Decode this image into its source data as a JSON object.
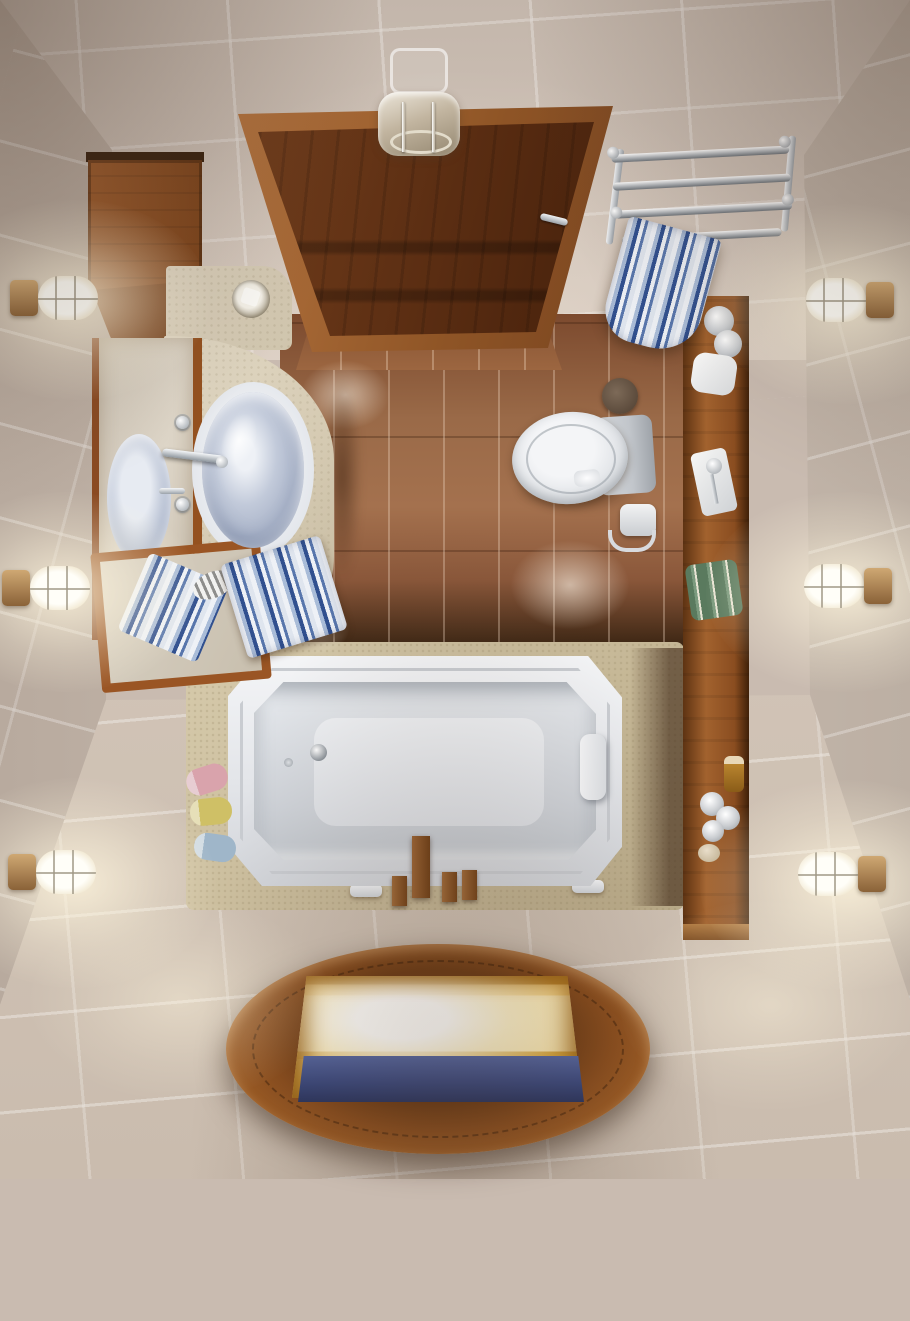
{
  "scene": {
    "description": "3D rendered top-down (bird's eye) view of a small bathroom with beige tiled walls and floor, dark wood accents, a white bathtub, corner vanity with glass vessel sink, toilet, chrome towel rack with blue striped towel, six glowing bulkhead wall lamps, and an oval wooden floor hatch glowing golden with blue water inside",
    "view": "overhead",
    "room_type": "bathroom"
  },
  "palette": {
    "wall_tile": "#cec1b6",
    "grout": "#e8ded2",
    "floor_tile_brown": "#9a6a48",
    "wood_dark": "#5a2d12",
    "wood_mid": "#8a4d20",
    "wood_light": "#a8683a",
    "stone_counter": "#d5cab2",
    "tub_white": "#eef0f3",
    "towel_navy": "#31508f",
    "towel_blue": "#a9bcd8",
    "lamp_glow": "#fff6de",
    "hatch_glow": "#f9e6ae",
    "water_blue": "#39477c",
    "chrome": "#d9dce0",
    "bronze": "#ae8a5e",
    "toilet_white": "#dcdfe3"
  },
  "counts": {
    "wall_lamps": 6,
    "sinks": 1,
    "mirrors": 2,
    "striped_towels": 3
  },
  "objects": {
    "walls": "Beige tiled walls in perspective",
    "floor": "Beige tiled floor",
    "brown_floor": "Brown tiled floor strip between door and bathtub",
    "door": "Open dark wood door seen from above",
    "door_handle": "Chrome door handle",
    "ceiling_fixture": "Glass and chrome fixture above the door",
    "cabinet": "Wall-mounted wooden storage cabinet",
    "vanity_mirror": "Wood-framed wall mirror reflecting the sink",
    "tilted_mirror": "Tilted wood-framed mirror reflecting a striped towel",
    "countertop": "Curved cream stone vanity countertop",
    "counter_slab": "Stone counter corner slab",
    "glass_cup": "Glass cup on the countertop",
    "sink": "Oval glass vessel sink",
    "faucet": "Chrome sink faucet with cross handles",
    "soap_dish": "Striped soap dish",
    "counter_towel": "Folded blue striped towel on the counter",
    "toilet": "White toilet seen from above",
    "toilet_tank": "Toilet cistern",
    "toilet_brush": "Toilet brush holder",
    "toilet_paper": "Toilet paper roll on chrome holder",
    "shelf": "Long wooden shelf column along the right side",
    "jars": "Chrome-lidded cosmetic jars",
    "soap_bar": "White soap dish on shelf",
    "razor_tray": "White tray with razor",
    "green_towels": "Rolled green striped towels",
    "amber_bottle": "Small amber bottle",
    "chrome_knobs": "Cluster of chrome jars",
    "pebble": "Beige pebble soap",
    "towel_rack": "Chrome wall towel rack",
    "hanging_towel": "Blue striped towel hanging from the rack",
    "bathtub": "White octagonal bathtub",
    "headrest": "White bath headrest pillow",
    "drain": "Chrome bathtub drain",
    "tub_faucet": "Wooden bathtub spout and handles",
    "bath_bottles": "Three pastel bath bottles beside the tub",
    "tub_feet": "White tub support feet",
    "floor_hatch": "Oval wooden floor hatch with glowing golden interior and blue water",
    "wall_lamp": "Glowing bulkhead wall lamp with bronze base"
  }
}
